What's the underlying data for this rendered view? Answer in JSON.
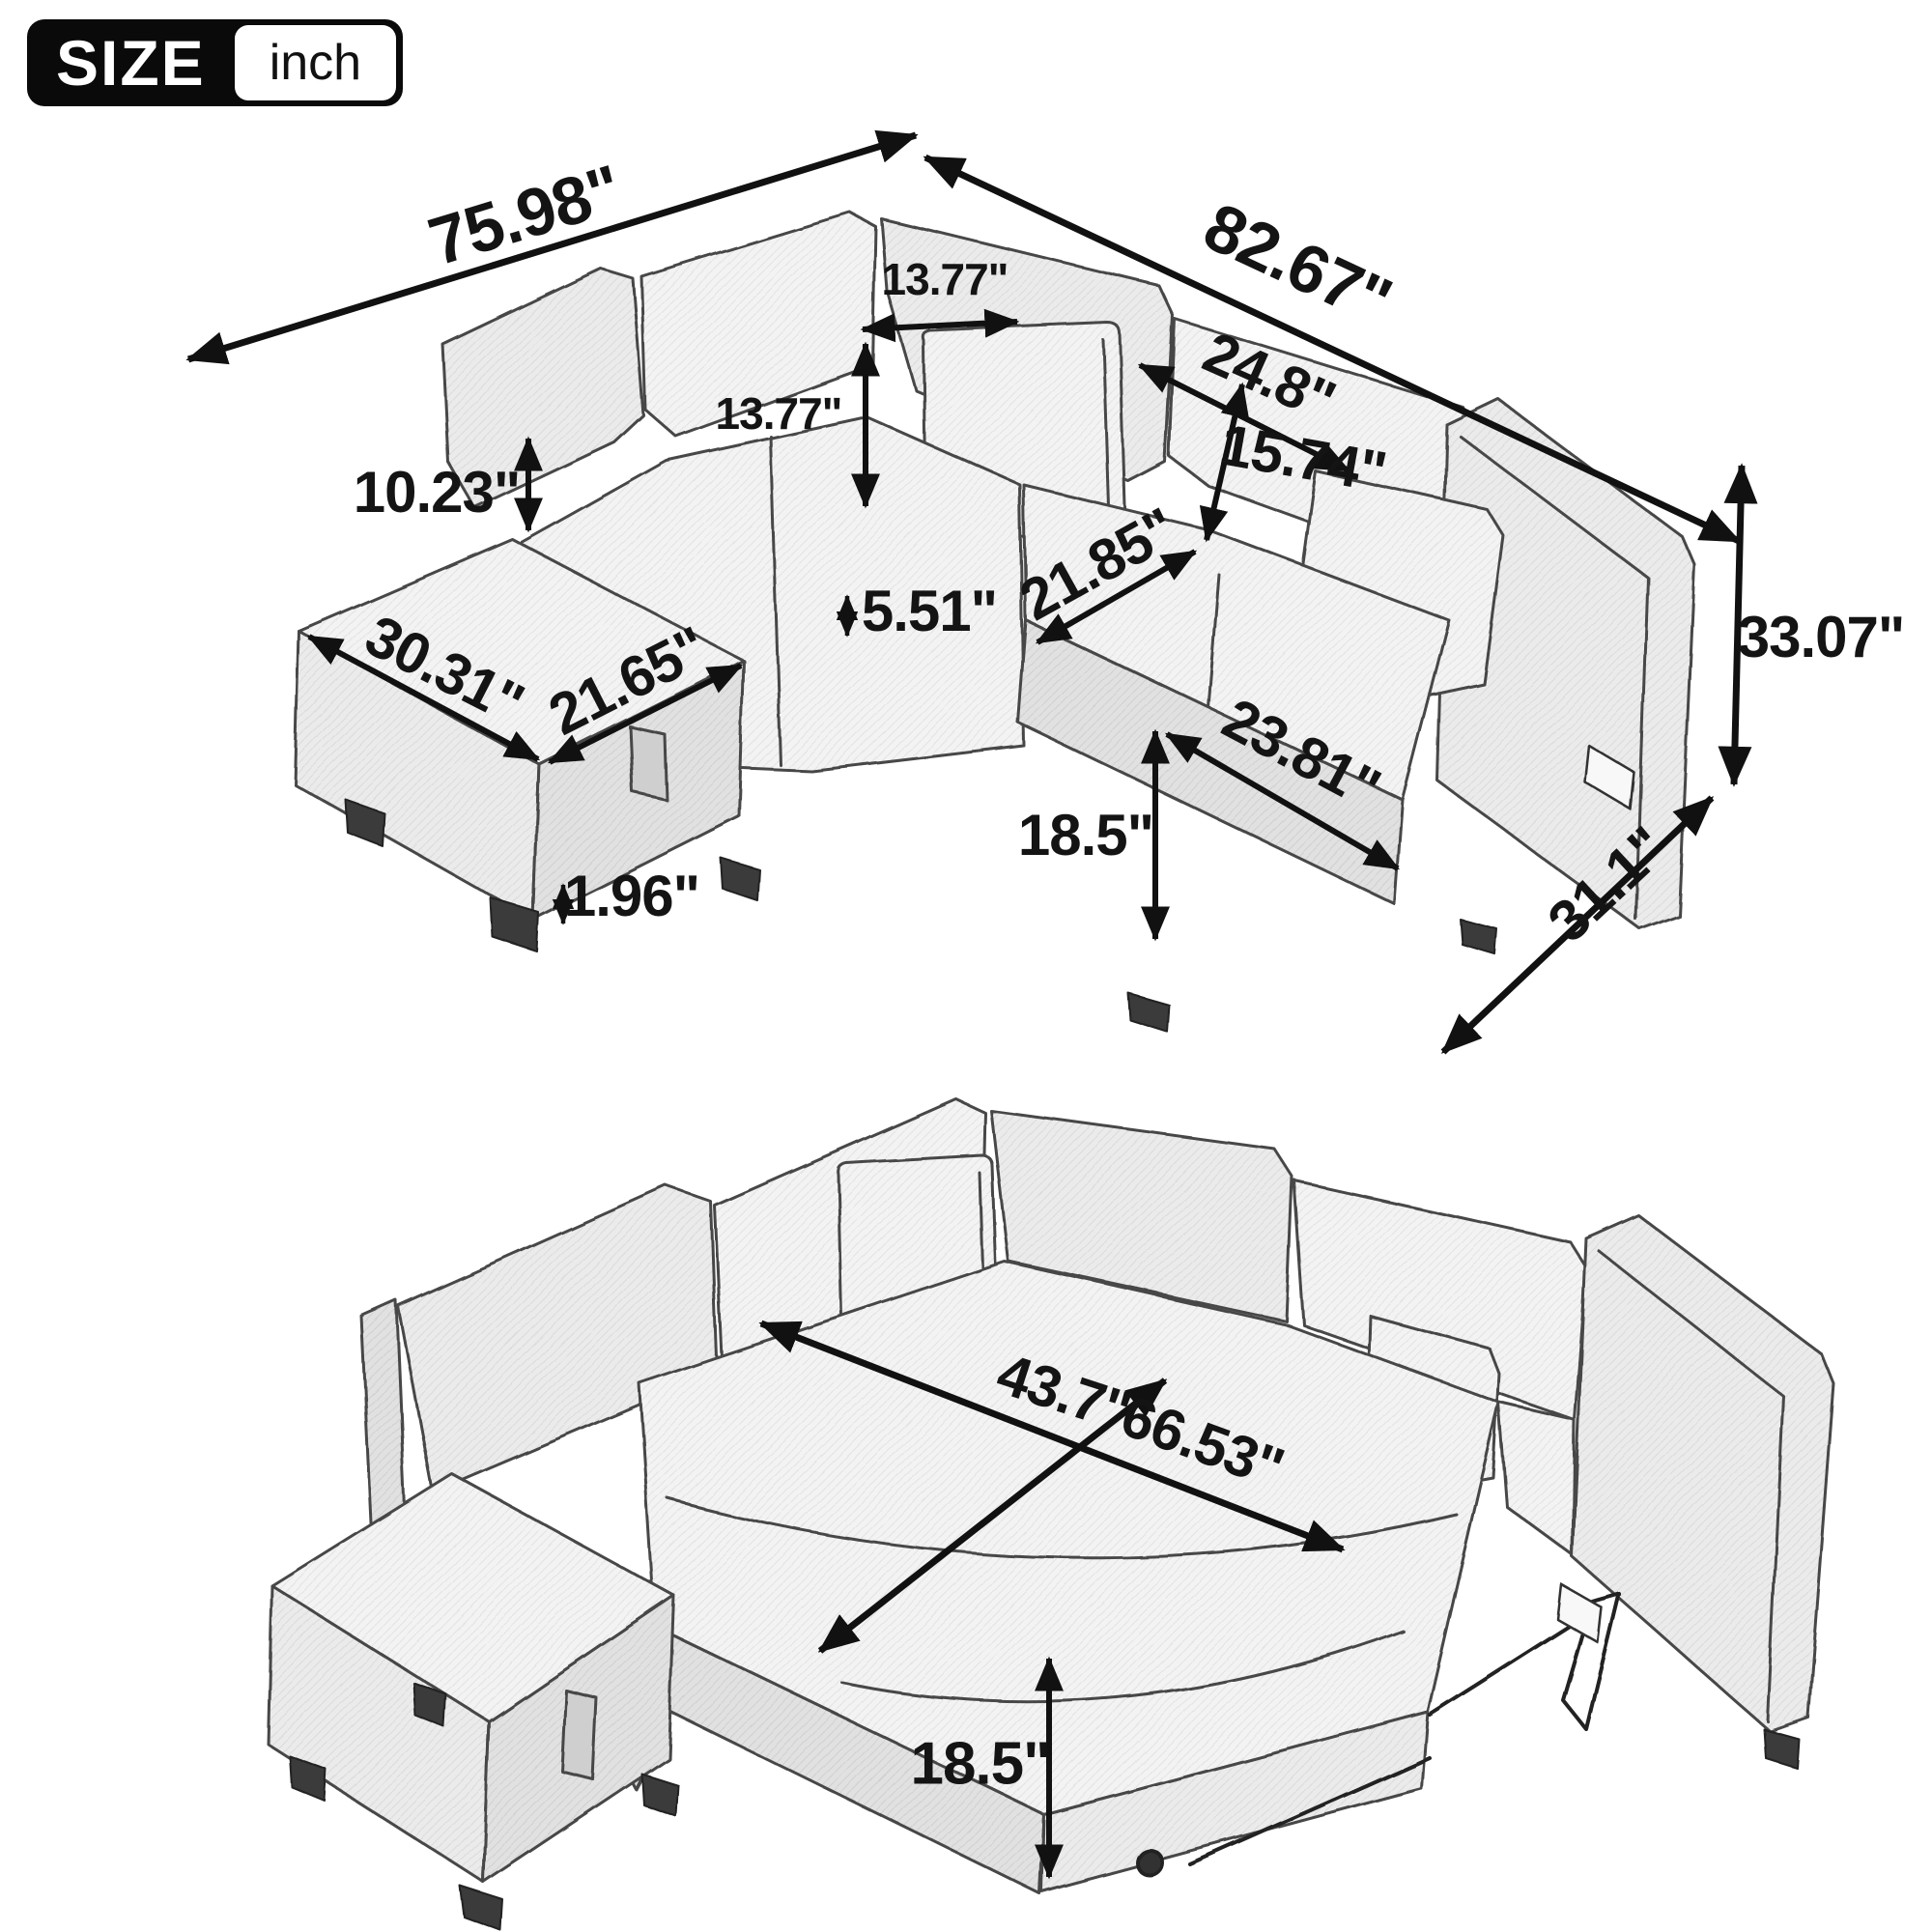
{
  "badge": {
    "size_label": "SIZE",
    "unit_label": "inch"
  },
  "colors": {
    "ink": "#111111",
    "paper": "#ffffff",
    "sketch_line": "#474747"
  },
  "assembled_view": {
    "name": "L-shaped sectional sofa with storage ottoman, sleeper retracted",
    "dimensions": {
      "overall_width_left": "75.98\"",
      "overall_width_right": "82.67\"",
      "corner_pillow_width": "13.77\"",
      "corner_pillow_height": "13.77\"",
      "back_cushion_width": "24.8\"",
      "back_cushion_height": "15.74\"",
      "backrest_above_ottoman": "10.23\"",
      "seat_depth": "21.85\"",
      "seat_cushion_thickness": "5.51\"",
      "ottoman_length": "30.31\"",
      "ottoman_depth": "21.65\"",
      "seat_width": "23.81\"",
      "seat_height": "18.5\"",
      "leg_height": "1.96\"",
      "overall_height": "33.07\"",
      "overall_depth": "31.1\""
    }
  },
  "bed_view": {
    "name": "Sectional sofa with pull-out sleeper extended",
    "dimensions": {
      "bed_width": "43.7\"",
      "bed_length": "66.53\"",
      "bed_height": "18.5\""
    }
  }
}
